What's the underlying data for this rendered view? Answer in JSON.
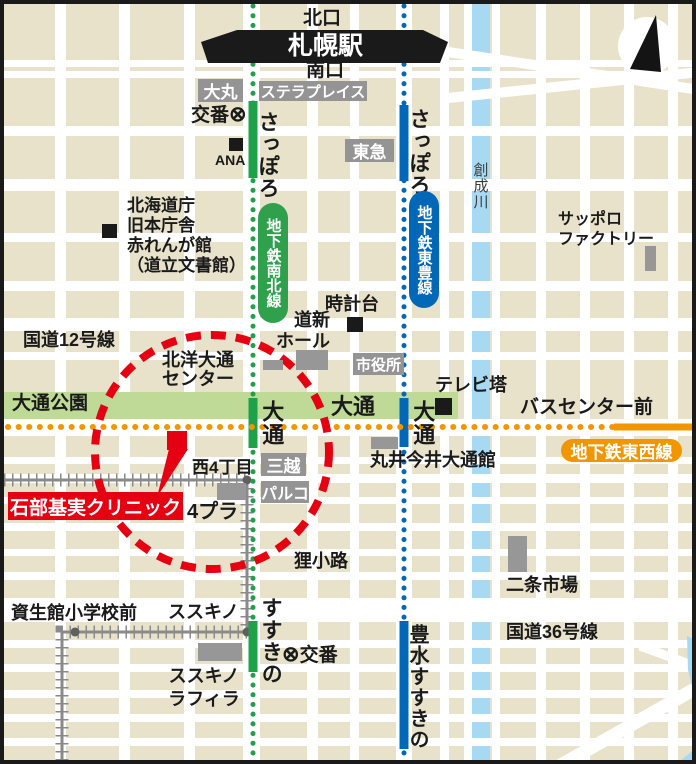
{
  "colors": {
    "namboku_green": "#1FA14A",
    "toho_blue": "#0068B7",
    "tozai_orange": "#F29600",
    "park_green": "#BFDA96",
    "river_blue": "#A7DAF2",
    "marker_red": "#E50012",
    "label_gray": "#949494",
    "block_tan": "#E9E2CB"
  },
  "station_area": {
    "north_exit": "北口",
    "station_name": "札幌駅",
    "south_exit": "南口",
    "stellar_place": "ステラプレイス",
    "daimaru": "大丸",
    "police_label": "交番",
    "police_symbol": "⊗",
    "ana": "ANA",
    "tokyu": "東急"
  },
  "subway": {
    "namboku_station_sapporo": "さっぽろ",
    "toho_station_sapporo": "さっぽろ",
    "namboku_line": "地下鉄南北線",
    "toho_line": "地下鉄東豊線",
    "tozai_line": "地下鉄東西線",
    "odori_station_center": "大通",
    "odori_station_namboku": "大通",
    "odori_station_toho": "大通",
    "bus_center_mae": "バスセンター前",
    "susukino_station": "すすきの",
    "hosui_susukino_station": "豊水すすきの"
  },
  "landmarks": {
    "pref_line1": "北海道庁",
    "pref_line2": "旧本庁舎",
    "pref_line3": "赤れんが館",
    "pref_line4": "（道立文書館）",
    "tokeidai": "時計台",
    "doshin_line1": "道新",
    "doshin_line2": "ホール",
    "shiyakusho": "市役所",
    "tv_tower": "テレビ塔",
    "hokuyo_line1": "北洋大通",
    "hokuyo_line2": "センター",
    "sapporo_factory_line1": "サッポロ",
    "sapporo_factory_line2": "ファクトリー",
    "mitsukoshi": "三越",
    "parco": "パルコ",
    "marui_imai": "丸井今井大通館",
    "yonpla": "4プラ",
    "tanukikoji": "狸小路",
    "nijo_market": "二条市場",
    "lafiler_line1": "ススキノ",
    "lafiler_line2": "ラフィラ",
    "sosei_river": "創成川"
  },
  "roads": {
    "route12": "国道12号線",
    "route36": "国道36号線",
    "odori_park": "大通公園"
  },
  "tram": {
    "nishi4chome": "西4丁目",
    "shiseikan_elementary": "資生館小学校前",
    "susukino_stop": "ススキノ",
    "police_label": "交番",
    "police_symbol": "⊗"
  },
  "clinic": {
    "name": "石部基実クリニック"
  }
}
